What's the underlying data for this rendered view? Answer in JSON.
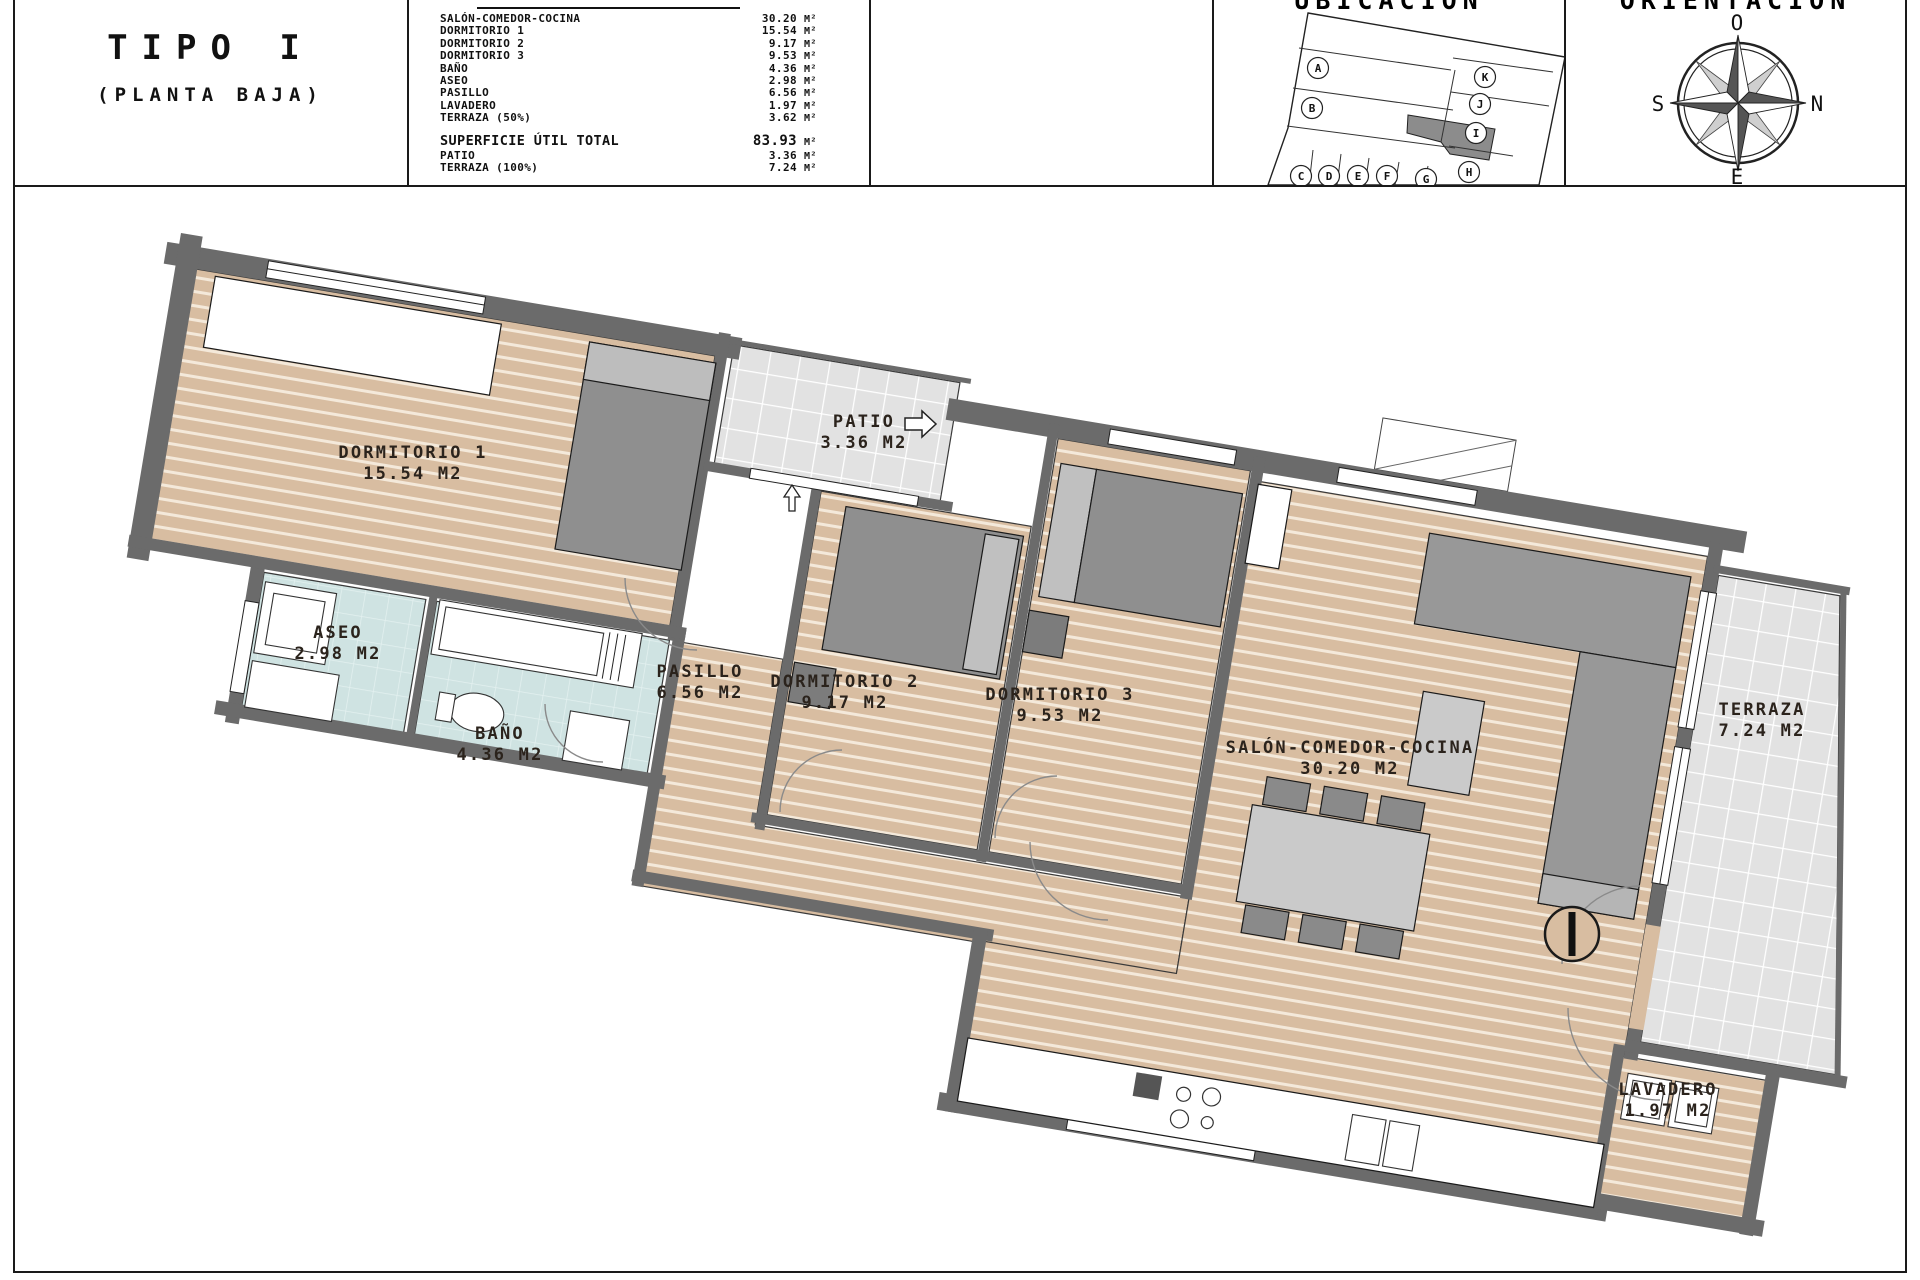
{
  "title_block": {
    "title": "TIPO I",
    "subtitle": "(PLANTA BAJA)"
  },
  "table": {
    "rows": [
      {
        "label": "SALÓN-COMEDOR-COCINA",
        "value": "30.20",
        "unit": "M²"
      },
      {
        "label": "DORMITORIO 1",
        "value": "15.54",
        "unit": "M²"
      },
      {
        "label": "DORMITORIO 2",
        "value": "9.17",
        "unit": "M²"
      },
      {
        "label": "DORMITORIO 3",
        "value": "9.53",
        "unit": "M²"
      },
      {
        "label": "BAÑO",
        "value": "4.36",
        "unit": "M²"
      },
      {
        "label": "ASEO",
        "value": "2.98",
        "unit": "M²"
      },
      {
        "label": "PASILLO",
        "value": "6.56",
        "unit": "M²"
      },
      {
        "label": "LAVADERO",
        "value": "1.97",
        "unit": "M²"
      },
      {
        "label": "TERRAZA (50%)",
        "value": "3.62",
        "unit": "M²"
      }
    ],
    "total": {
      "label": "SUPERFICIE ÚTIL TOTAL",
      "value": "83.93",
      "unit": "M²"
    },
    "extras": [
      {
        "label": "PATIO",
        "value": "3.36",
        "unit": "M²"
      },
      {
        "label": "TERRAZA (100%)",
        "value": "7.24",
        "unit": "M²"
      }
    ]
  },
  "location": {
    "header": "UBICACIÓN",
    "highlighted_unit": "I",
    "letters": [
      "A",
      "B",
      "C",
      "D",
      "E",
      "F",
      "G",
      "H",
      "I",
      "J",
      "K"
    ]
  },
  "orientation": {
    "header": "ORIENTACIÓN",
    "points": {
      "top": "O",
      "right": "N",
      "left": "S",
      "bottom": "E"
    }
  },
  "plan": {
    "unit_marker": "I",
    "rooms": [
      {
        "name": "DORMITORIO 1",
        "area": "15.54 M2"
      },
      {
        "name": "DORMITORIO 2",
        "area": "9.17 M2"
      },
      {
        "name": "DORMITORIO 3",
        "area": "9.53 M2"
      },
      {
        "name": "SALÓN-COMEDOR-COCINA",
        "area": "30.20 M2"
      },
      {
        "name": "BAÑO",
        "area": "4.36 M2"
      },
      {
        "name": "ASEO",
        "area": "2.98 M2"
      },
      {
        "name": "PASILLO",
        "area": "6.56 M2"
      },
      {
        "name": "LAVADERO",
        "area": "1.97 M2"
      },
      {
        "name": "TERRAZA",
        "area": "7.24 M2"
      },
      {
        "name": "PATIO",
        "area": "3.36 M2"
      }
    ],
    "colors": {
      "wood": "#d8bda1",
      "tile": "#e4e4e4",
      "bath": "#cfe3e2",
      "wall": "#6b6b6b",
      "highlight": "#8c8c8c"
    }
  }
}
